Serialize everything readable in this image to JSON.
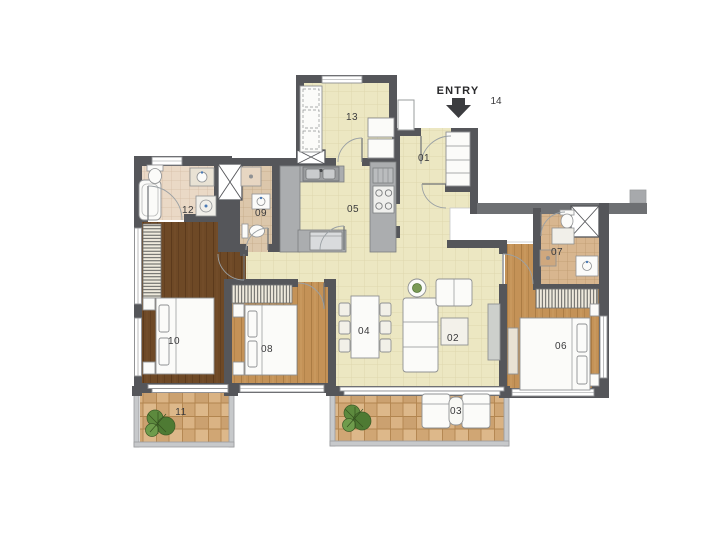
{
  "entry": {
    "label": "ENTRY",
    "number": "14"
  },
  "rooms": [
    {
      "number": "01"
    },
    {
      "number": "02"
    },
    {
      "number": "03"
    },
    {
      "number": "04"
    },
    {
      "number": "05"
    },
    {
      "number": "06"
    },
    {
      "number": "07"
    },
    {
      "number": "08"
    },
    {
      "number": "09"
    },
    {
      "number": "10"
    },
    {
      "number": "11"
    },
    {
      "number": "12"
    },
    {
      "number": "13"
    }
  ],
  "colors": {
    "wall": "#55565a",
    "wall_band": "#6e7073",
    "floor_main": "#ece7c2",
    "floor_wood_dark": "#6e4926",
    "floor_wood_tan": "#c49257",
    "balcony_tile": "#d2a978",
    "bath_tile_light": "#ead9c6",
    "bath_tile_mid": "#dcc7ab",
    "bath_tile_tan": "#d8b68f",
    "counter": "#abadaf",
    "label_text": "#3a3a3c"
  }
}
